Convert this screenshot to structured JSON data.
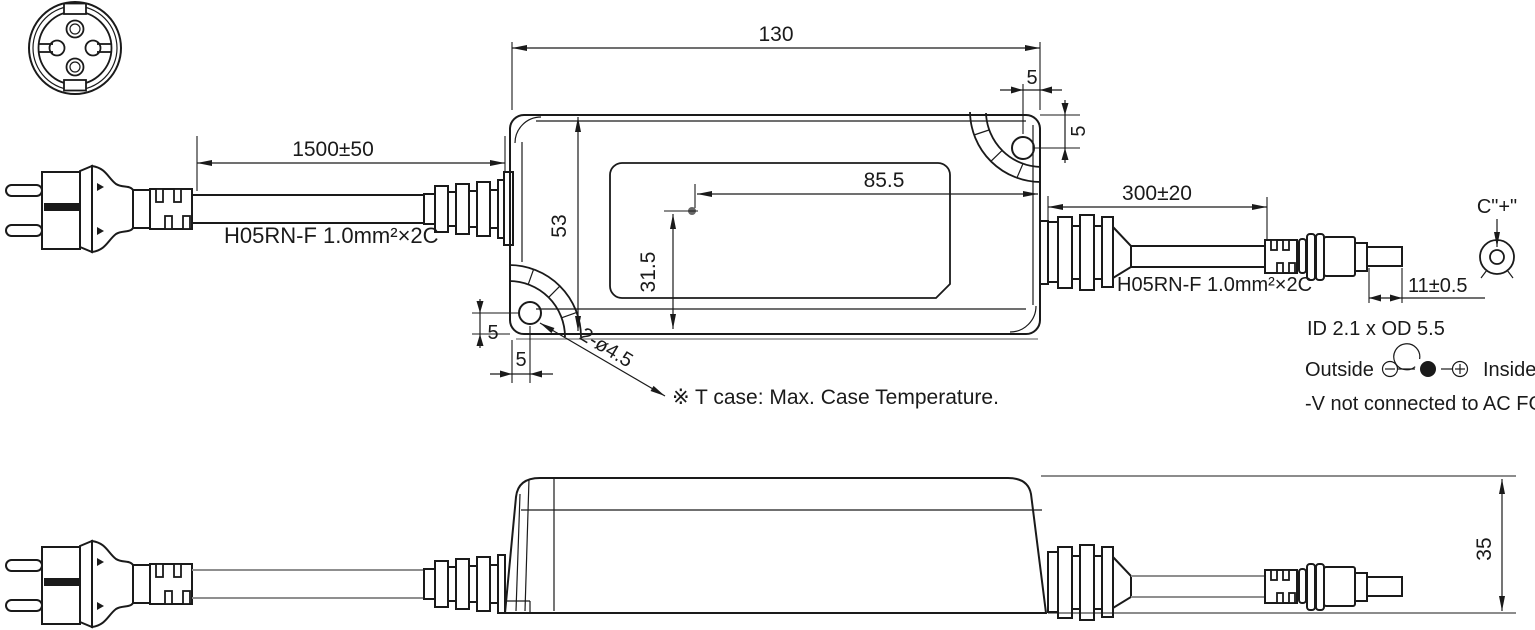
{
  "page": {
    "background": "#ffffff"
  },
  "colors": {
    "line": "#1a1a1a",
    "gray_line": "#8f8f8f",
    "tcase_dot": "#666666"
  },
  "top_view": {
    "dim_overall_length": "130",
    "dim_hole_to_edge_x": "5",
    "dim_hole_to_edge_y": "5",
    "dim_input_cable": "1500±50",
    "input_cable_spec": "H05RN-F 1.0mm²×2C",
    "dim_case_width": "53",
    "dim_tcase_from_right": "85.5",
    "dim_tcase_from_bottom": "31.5",
    "dim_output_cable": "300±20",
    "output_cable_spec": "H05RN-F 1.0mm²×2C",
    "dim_dc_plug_length": "11±0.5",
    "dim_hole_left_y": "5",
    "dim_hole_left_x": "5",
    "mounting_holes_label": "2-ø4.5"
  },
  "side_view": {
    "dim_case_height": "35"
  },
  "notes": {
    "tcase_note": "※ T case: Max. Case Temperature.",
    "dc_connector_label": "C\"+\"",
    "dc_plug_size": "ID 2.1 x OD 5.5",
    "polarity_outside": "Outside",
    "polarity_inside": "Inside",
    "fg_note": "-V not connected to AC FG"
  }
}
